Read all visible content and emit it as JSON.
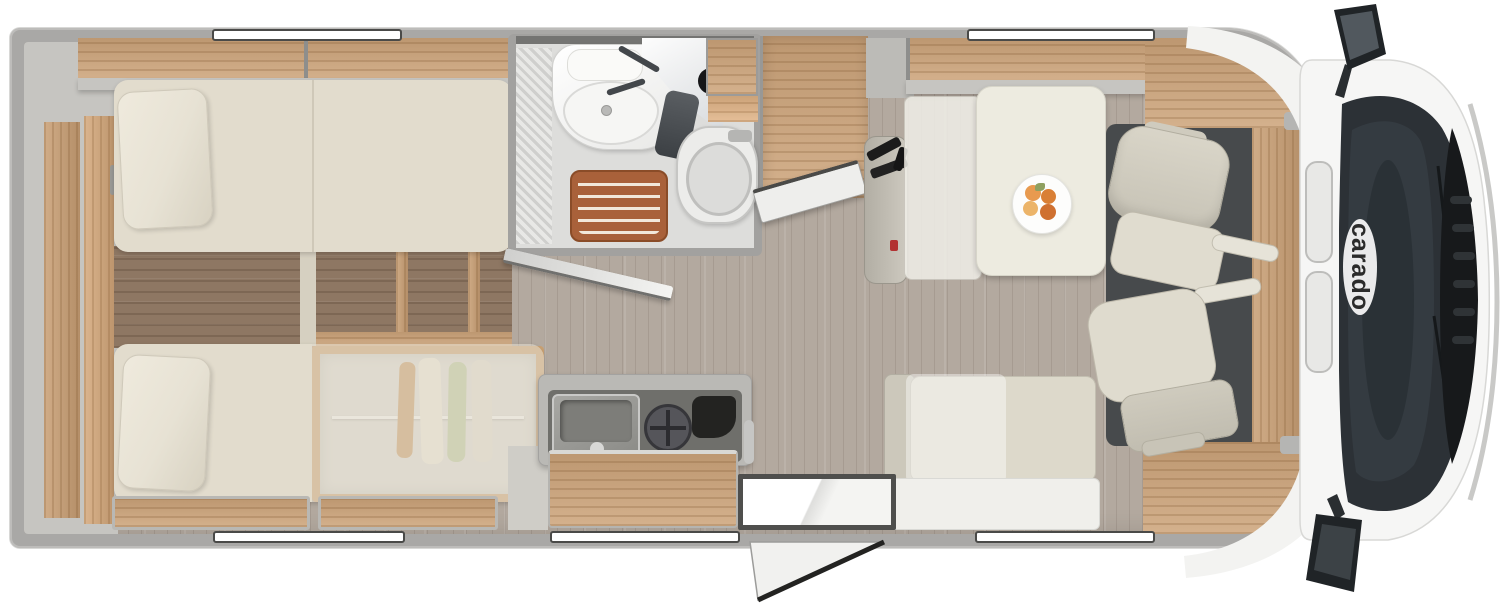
{
  "brand": {
    "logo": "carado"
  },
  "colors": {
    "body_wall": "#a9a8a6",
    "wood": "#cda47a",
    "living_floor": "#b3a99f",
    "bedroom_floor": "#8e7763",
    "mattress": "#e2dccd",
    "cushion": "#ddd9cb",
    "cab_floor_mat": "#474a4c",
    "windshield": "#2c3136",
    "shower_mat": "#a9613a",
    "seatbelt_red": "#b23232"
  },
  "floorplan": {
    "rooms": [
      "rear-twin-bedroom",
      "bathroom",
      "kitchen",
      "dinette",
      "cab"
    ],
    "windows": [
      {
        "side": "top",
        "area": "bedroom"
      },
      {
        "side": "top",
        "area": "dinette"
      },
      {
        "side": "bottom",
        "area": "bedroom"
      },
      {
        "side": "bottom",
        "area": "kitchen"
      },
      {
        "side": "bottom",
        "area": "dinette"
      }
    ],
    "features": [
      "twin-bed-top",
      "twin-bed-bottom",
      "bed-steps",
      "underbed-wardrobe",
      "clothes-hangers",
      "shower",
      "washbasin",
      "vanity-mirror",
      "toilet",
      "shower-wood-mat",
      "bathroom-door",
      "tall-cabinet",
      "kitchen-counter",
      "kitchen-sink",
      "gas-hob",
      "kitchen-drawers",
      "entry-step",
      "entry-door",
      "dinette-table",
      "fruit-plate",
      "belted-travel-bench",
      "rear-bench",
      "driver-swivel-seat",
      "passenger-swivel-seat",
      "dashboard",
      "windshield",
      "side-mirror-left",
      "side-mirror-right",
      "sunroof-panels"
    ]
  }
}
